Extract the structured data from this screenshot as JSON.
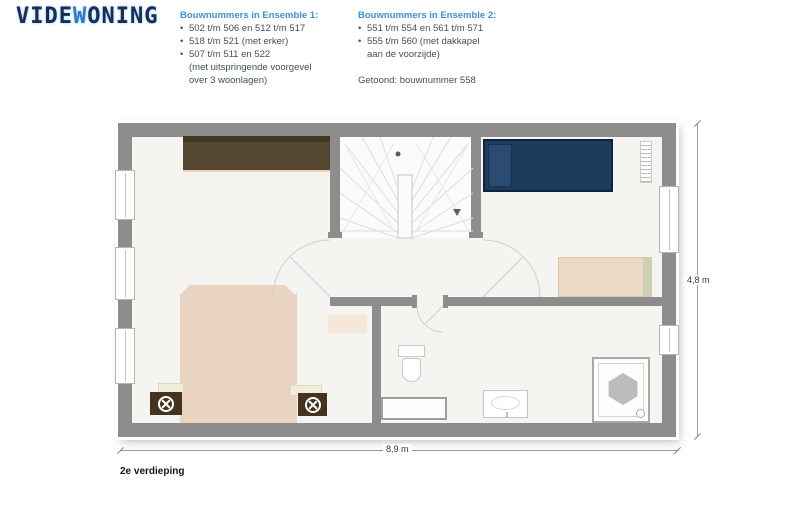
{
  "logo": {
    "part1": "VIDE",
    "part2": "W",
    "part3": "ONING"
  },
  "ui": {
    "bullet_char": "•"
  },
  "ensembles": [
    {
      "title": "Bouwnummers in Ensemble 1:",
      "bullets": [
        "502 t/m 506 en 512 t/m 517",
        "518 t/m 521 (met erker)",
        "507 t/m 511 en 522"
      ],
      "continuation": [
        "(met uitspringende voorgevel",
        "over 3 woonlagen)"
      ]
    },
    {
      "title": "Bouwnummers in Ensemble 2:",
      "bullets": [
        "551 t/m 554 en 561 t/m 571",
        "555 t/m 560 (met dakkapel"
      ],
      "continuation": [
        "aan de voorzijde)"
      ],
      "shown": "Getoond: bouwnummer 558"
    }
  ],
  "plan": {
    "floor_label": "2e verdieping",
    "dimension_width": "8,9 m",
    "dimension_height": "4,8 m"
  },
  "colors": {
    "accent_blue": "#3e92d3",
    "logo_navy": "#1d2b57",
    "logo_blue": "#2e7bc9",
    "body_text": "#41505b",
    "wall_gray": "#8d8d8d",
    "floor": "#f6f4f1",
    "bed_navy": "#1d3b5d",
    "bed_tan": "#e9d4c2",
    "wardrobe_brown": "#55462f",
    "nightstand_brown": "#46331f",
    "desk_beige": "#ecd9c3"
  }
}
